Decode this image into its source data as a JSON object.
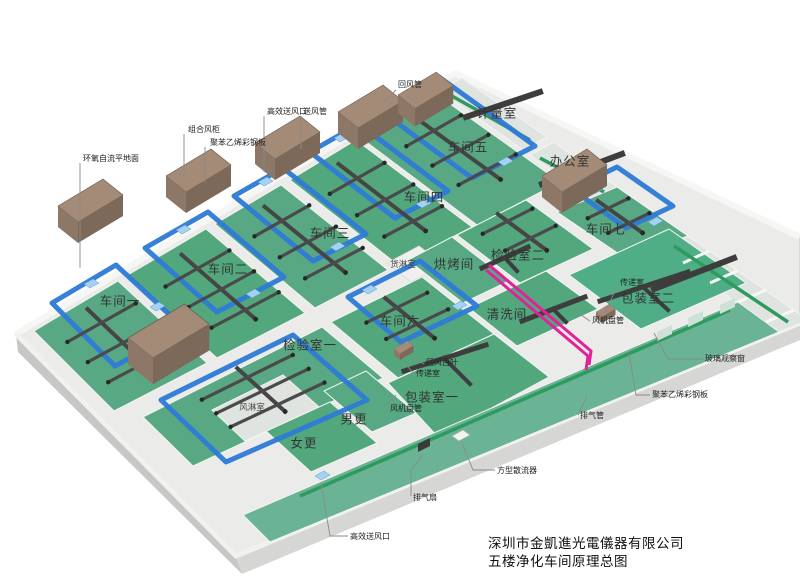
{
  "title": {
    "line1": "深圳市金凱進光電儀器有限公司",
    "line2": "五楼净化车间原理总图"
  },
  "rooms": {
    "ws1": "车间一",
    "ws2": "车间二",
    "ws3": "车间三",
    "ws4": "车间四",
    "ws5": "车间五",
    "ws6": "车间六",
    "ws7": "车间七",
    "inspection1": "检验室一",
    "inspection2": "检验室二",
    "baking": "烘烤间",
    "cleaning": "清洗间",
    "metering": "计量室",
    "office": "办公室",
    "packing1": "包装室一",
    "packing2": "包装室二",
    "women": "女更",
    "men": "男更",
    "air_shower": "风淋室",
    "cargo_shower": "货淋室"
  },
  "callouts": {
    "epoxy_floor": "环氧自流平地面",
    "ahu": "组合风柜",
    "panel1": "聚苯乙烯彩钢板",
    "hepa1": "高效送风口",
    "supply_duct": "送风管",
    "return_duct": "回风管",
    "return_louver": "回风百叶",
    "pass_box1": "传递室",
    "fcu1": "风机盘管",
    "fcu2": "风机盘管",
    "pass_box2": "传递室",
    "exhaust_pipe": "排气管",
    "glass_window": "玻璃观察窗",
    "panel2": "聚苯乙烯彩钢板",
    "exhaust_fan": "排气扇",
    "diffuser": "方型散流器",
    "hepa2": "高效送风口"
  },
  "colors": {
    "floor_green_1": "#58a983",
    "floor_green_2": "#52a77d",
    "floor_green_3": "#4fae86",
    "duct_blue": "#2f7cd6",
    "duct_blue_light": "#a5d2f2",
    "stripe_green": "#2e9a60",
    "pink_pipe": "#e3219b",
    "ahu_brown": "#8d7663",
    "duct_dark": "#454545"
  }
}
